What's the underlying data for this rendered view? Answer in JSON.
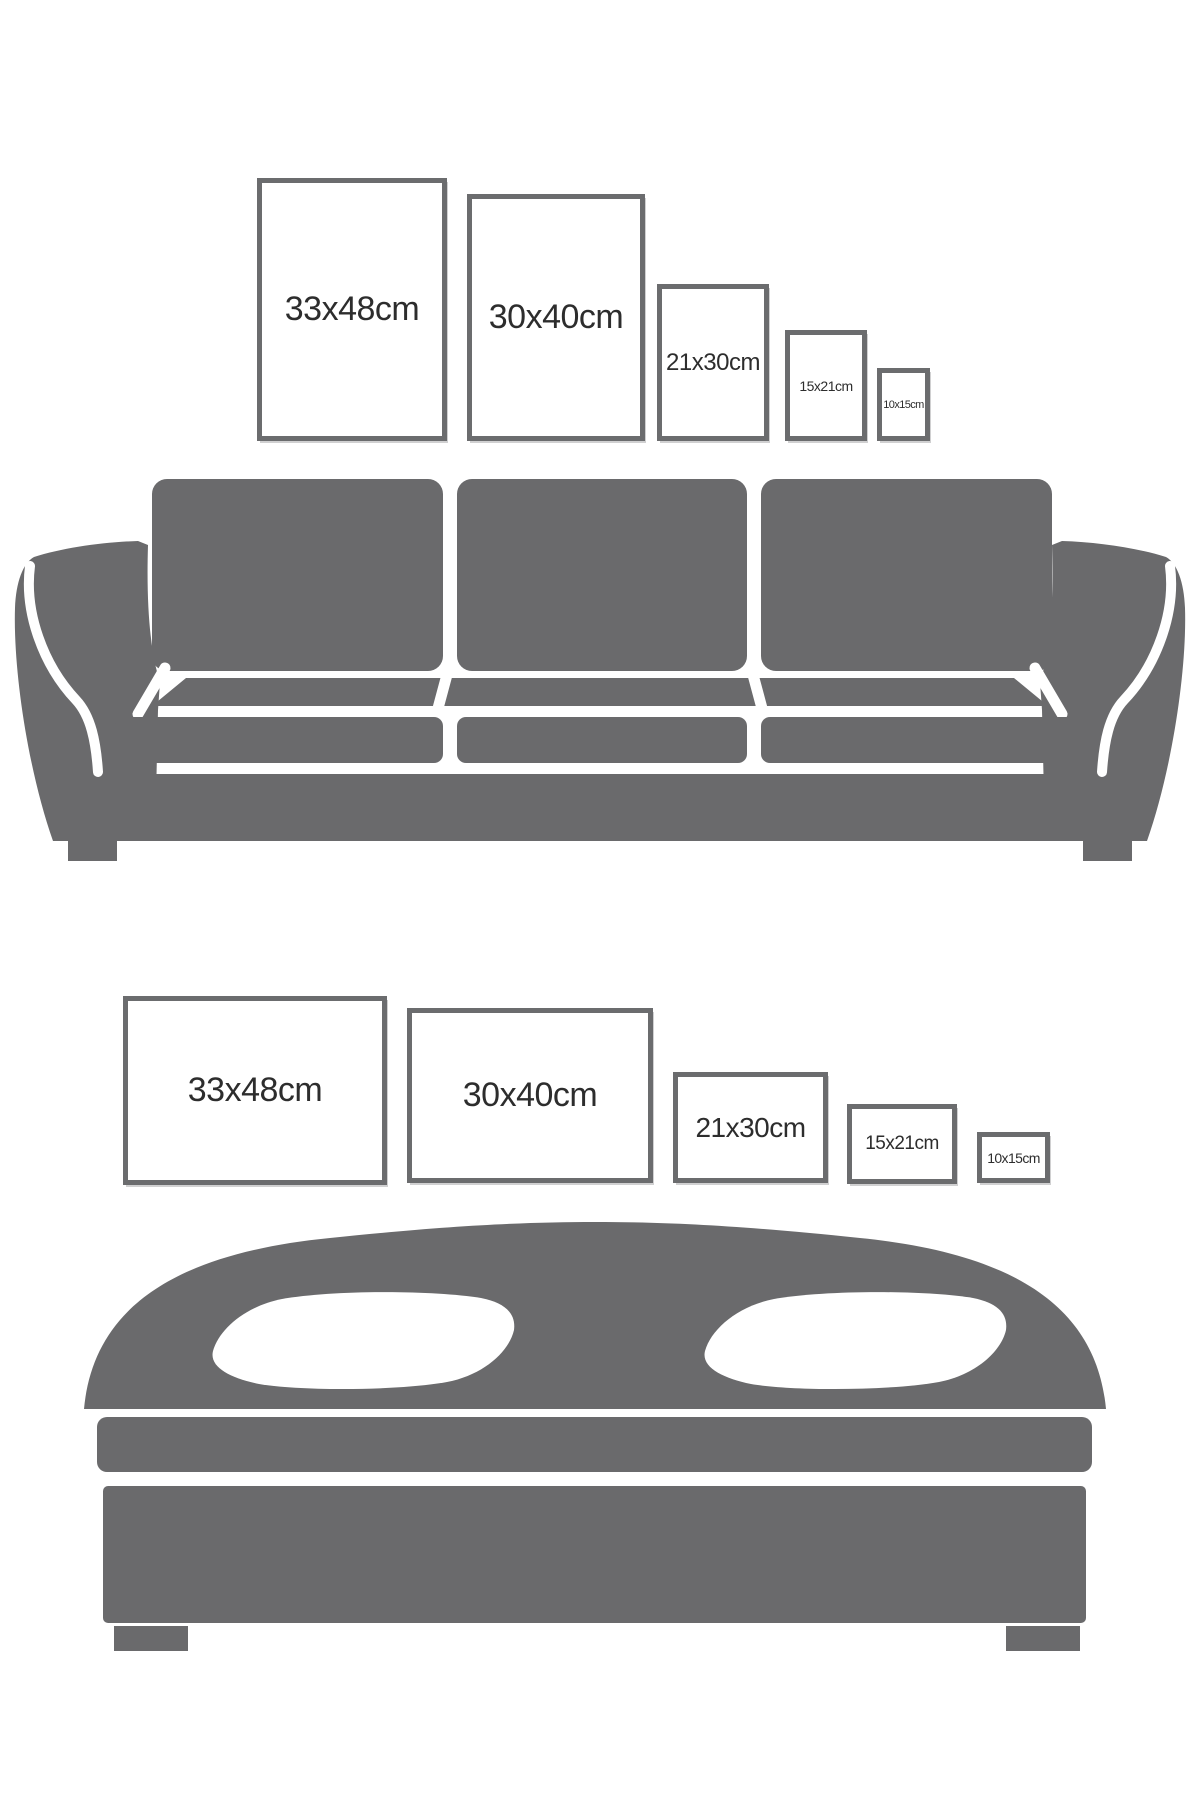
{
  "sofa_section": {
    "furniture_icon": "sofa-icon",
    "frames": [
      {
        "label": "33x48cm",
        "orientation": "portrait"
      },
      {
        "label": "30x40cm",
        "orientation": "portrait"
      },
      {
        "label": "21x30cm",
        "orientation": "portrait"
      },
      {
        "label": "15x21cm",
        "orientation": "portrait"
      },
      {
        "label": "10x15cm",
        "orientation": "portrait"
      }
    ]
  },
  "bed_section": {
    "furniture_icon": "bed-icon",
    "frames": [
      {
        "label": "33x48cm",
        "orientation": "landscape"
      },
      {
        "label": "30x40cm",
        "orientation": "landscape"
      },
      {
        "label": "21x30cm",
        "orientation": "landscape"
      },
      {
        "label": "15x21cm",
        "orientation": "landscape"
      },
      {
        "label": "10x15cm",
        "orientation": "landscape"
      }
    ]
  },
  "colors": {
    "furniture_gray": "#6a6a6c",
    "frame_border": "#6b6c6e",
    "label_text": "#2d2d2d",
    "background": "#ffffff"
  }
}
